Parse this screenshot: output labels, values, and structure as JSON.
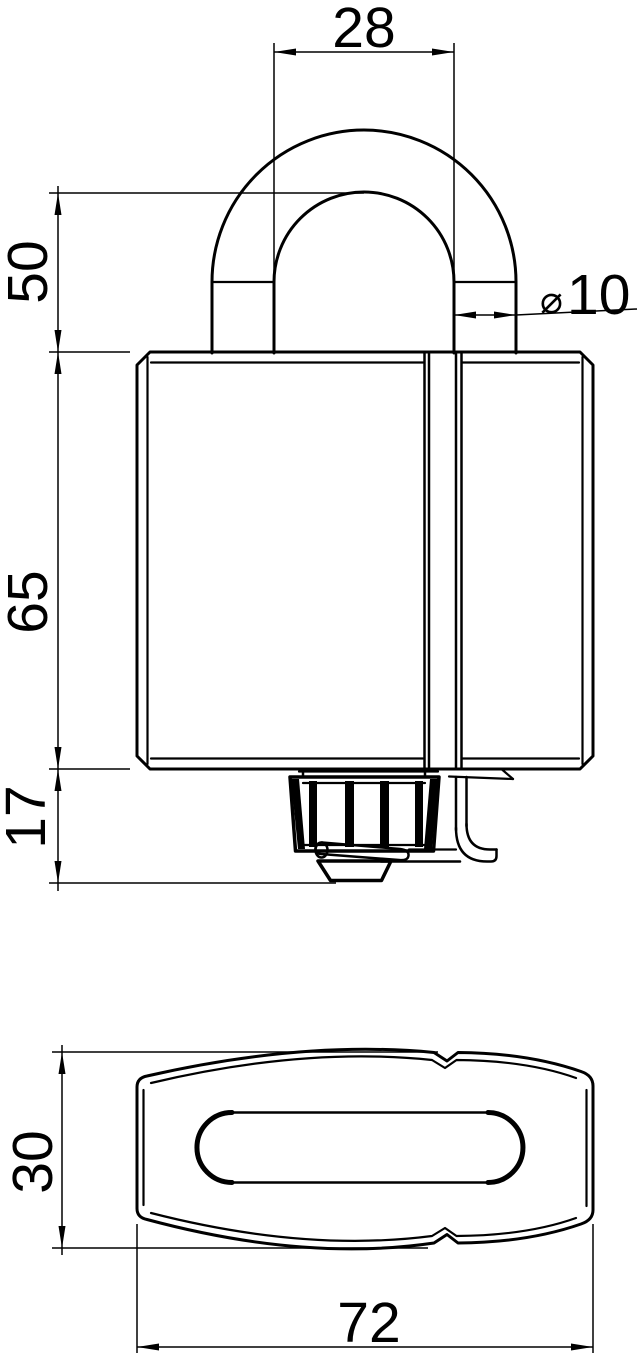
{
  "page": {
    "background": "#ffffff",
    "line_color": "#000000"
  },
  "drawing": {
    "subject": "padlock technical drawing, front view and bottom view",
    "dims": {
      "shackle_inner_width": "28",
      "shackle_clearance_height": "50",
      "shackle_diameter_symbol": "⌀",
      "shackle_diameter": "10",
      "body_height": "65",
      "knob_height": "17",
      "body_depth": "30",
      "body_width": "72"
    }
  }
}
